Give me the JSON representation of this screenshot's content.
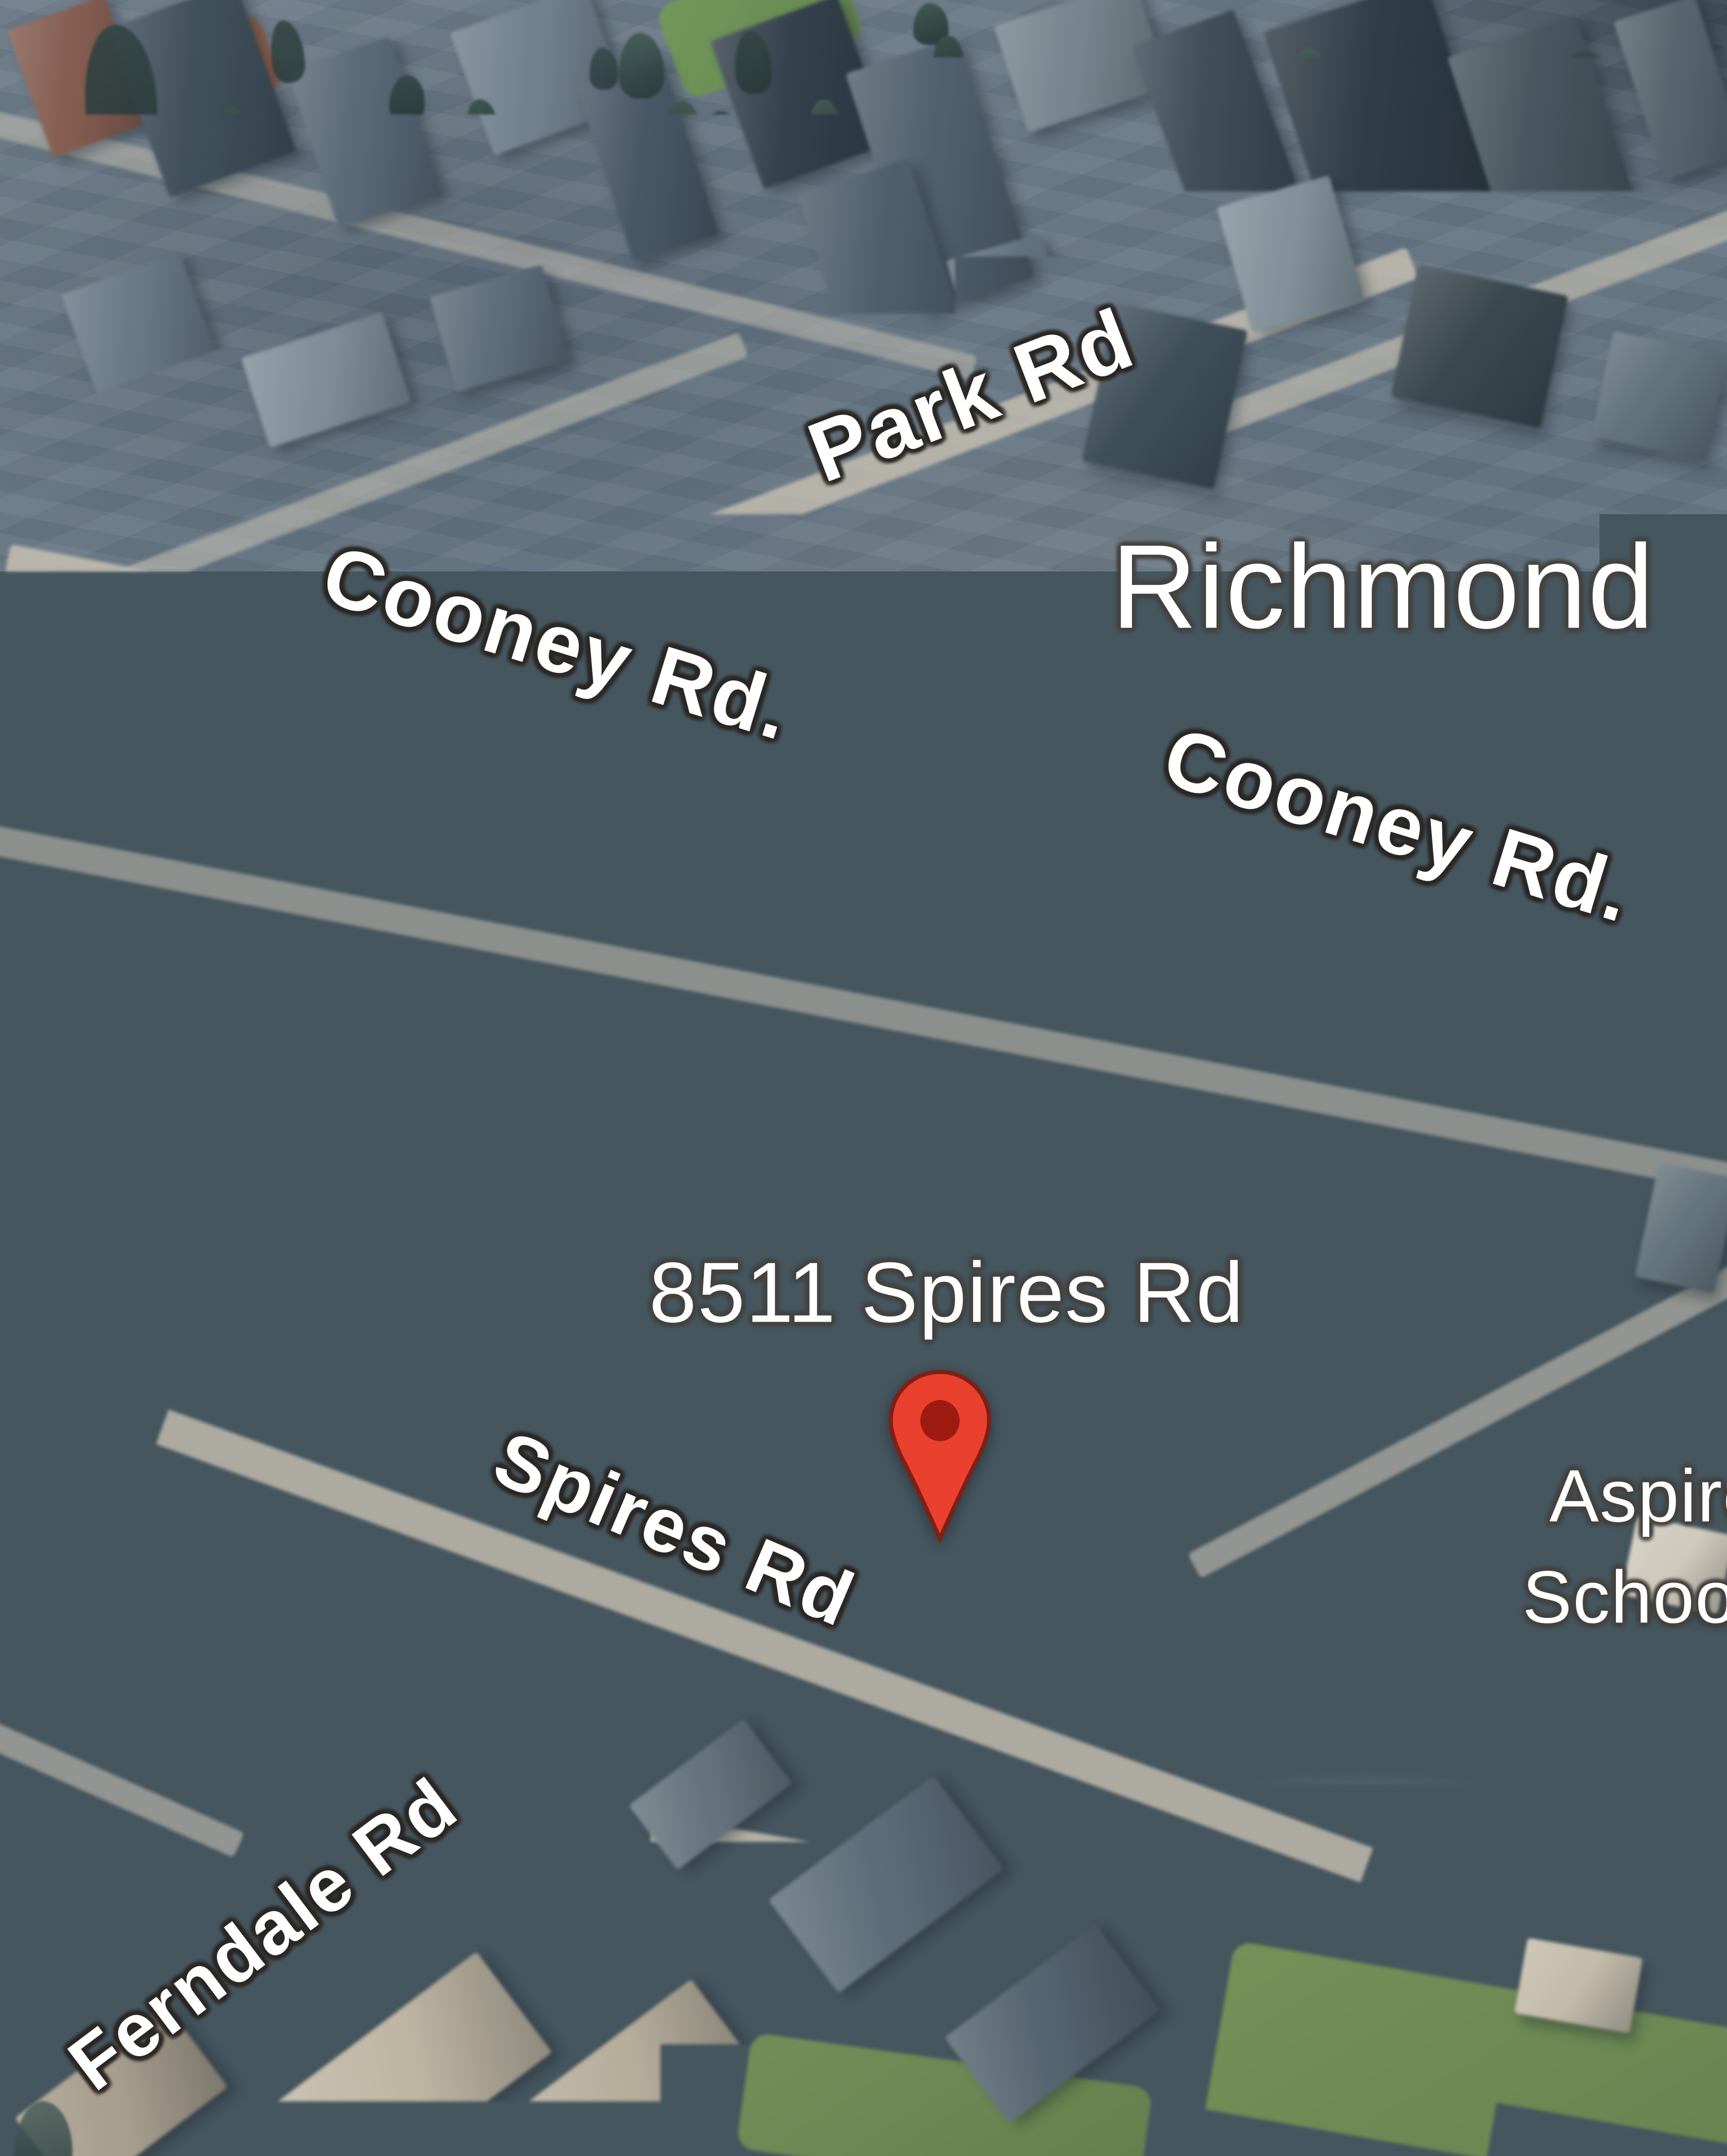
{
  "map": {
    "view_type": "3D satellite aerial view",
    "city_label": "Richmond",
    "marker": {
      "address_label": "8511 Spires Rd",
      "icon": "map-pin-icon",
      "pin_color": "#E9412E",
      "pin_inner_color": "#9E1B12",
      "pin_outline_color": "#7E2018"
    },
    "road_labels": [
      {
        "text": "Park Rd"
      },
      {
        "text": "Cooney Rd."
      },
      {
        "text": "Cooney Rd."
      },
      {
        "text": "Spires Rd"
      },
      {
        "text": "Ferndale Rd"
      }
    ],
    "poi_label": {
      "line1": "Aspire",
      "line2": "Schoo"
    },
    "label_text_color": "#FFFFFF"
  }
}
